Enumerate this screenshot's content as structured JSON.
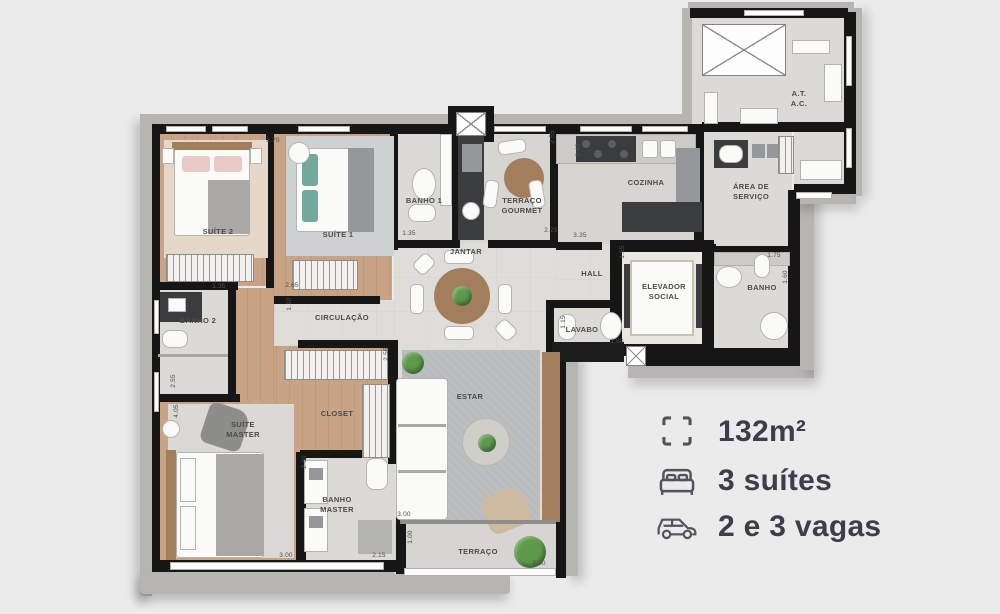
{
  "plan": {
    "rooms": [
      {
        "id": "suite-2",
        "label": "SUÍTE 2",
        "x": 218,
        "y": 232
      },
      {
        "id": "suite-1",
        "label": "SUÍTE 1",
        "x": 338,
        "y": 235
      },
      {
        "id": "banho-1",
        "label": "BANHO 1",
        "x": 424,
        "y": 201
      },
      {
        "id": "terraco-gourmet",
        "label": "TERRAÇO\nGOURMET",
        "x": 522,
        "y": 206
      },
      {
        "id": "cozinha",
        "label": "COZINHA",
        "x": 646,
        "y": 183
      },
      {
        "id": "area-servico",
        "label": "ÁREA DE\nSERVIÇO",
        "x": 751,
        "y": 192
      },
      {
        "id": "at-ac",
        "label": "A.T.\nA.C.",
        "x": 799,
        "y": 99
      },
      {
        "id": "jantar",
        "label": "JANTAR",
        "x": 466,
        "y": 252
      },
      {
        "id": "hall",
        "label": "HALL",
        "x": 592,
        "y": 274
      },
      {
        "id": "elevador-social",
        "label": "ELEVADOR\nSOCIAL",
        "x": 664,
        "y": 292
      },
      {
        "id": "banho-social",
        "label": "BANHO",
        "x": 762,
        "y": 288
      },
      {
        "id": "lavabo",
        "label": "LAVABO",
        "x": 582,
        "y": 330
      },
      {
        "id": "circulacao",
        "label": "CIRCULAÇÃO",
        "x": 342,
        "y": 318
      },
      {
        "id": "banho-2",
        "label": "BANHO 2",
        "x": 198,
        "y": 321
      },
      {
        "id": "closet",
        "label": "CLOSET",
        "x": 337,
        "y": 414
      },
      {
        "id": "suite-master",
        "label": "SUÍTE\nMASTER",
        "x": 243,
        "y": 430
      },
      {
        "id": "banho-master",
        "label": "BANHO\nMASTER",
        "x": 337,
        "y": 505
      },
      {
        "id": "estar",
        "label": "ESTAR",
        "x": 470,
        "y": 397
      },
      {
        "id": "terraco",
        "label": "TERRAÇO",
        "x": 478,
        "y": 552
      }
    ],
    "dimensions": [
      {
        "text": "2.70",
        "x": 273,
        "y": 141,
        "rot": 0
      },
      {
        "text": "2.55",
        "x": 553,
        "y": 137,
        "rot": 90
      },
      {
        "text": "2.40",
        "x": 579,
        "y": 150,
        "rot": 90
      },
      {
        "text": "1.35",
        "x": 409,
        "y": 234,
        "rot": 0
      },
      {
        "text": "2.25",
        "x": 551,
        "y": 231,
        "rot": 0
      },
      {
        "text": "3.35",
        "x": 580,
        "y": 236,
        "rot": 0
      },
      {
        "text": "1.55",
        "x": 623,
        "y": 252,
        "rot": 90
      },
      {
        "text": "1.75",
        "x": 774,
        "y": 256,
        "rot": 0
      },
      {
        "text": "1.60",
        "x": 786,
        "y": 277,
        "rot": 90
      },
      {
        "text": "1.35",
        "x": 219,
        "y": 287,
        "rot": 0
      },
      {
        "text": "2.65",
        "x": 292,
        "y": 286,
        "rot": 0
      },
      {
        "text": "1.10",
        "x": 290,
        "y": 304,
        "rot": 90
      },
      {
        "text": "2.55",
        "x": 174,
        "y": 381,
        "rot": 90
      },
      {
        "text": "2.55",
        "x": 387,
        "y": 354,
        "rot": 90
      },
      {
        "text": "1.15",
        "x": 564,
        "y": 322,
        "rot": 90
      },
      {
        "text": "1.60",
        "x": 617,
        "y": 342,
        "rot": 0
      },
      {
        "text": "4.05",
        "x": 177,
        "y": 411,
        "rot": 90
      },
      {
        "text": "2.60",
        "x": 305,
        "y": 462,
        "rot": 90
      },
      {
        "text": "3.00",
        "x": 286,
        "y": 556,
        "rot": 0
      },
      {
        "text": "2.15",
        "x": 379,
        "y": 556,
        "rot": 0
      },
      {
        "text": "3.00",
        "x": 404,
        "y": 515,
        "rot": 0
      },
      {
        "text": "1.00",
        "x": 411,
        "y": 537,
        "rot": 90
      },
      {
        "text": "3.30",
        "x": 539,
        "y": 564,
        "rot": 0
      }
    ]
  },
  "legend": {
    "items": [
      {
        "icon": "area-icon",
        "label": "132m²"
      },
      {
        "icon": "bed-icon",
        "label": "3 suítes"
      },
      {
        "icon": "car-icon",
        "label": "2 e 3 vagas"
      }
    ]
  },
  "colors": {
    "background": "#ebebeb",
    "wall": "#161616",
    "slab": "#b6b5b2",
    "wood_floor": "#c9a385",
    "stone_floor": "#deddda",
    "legend_text": "#3d3d4b",
    "plant_green": "#5d9a4c"
  }
}
